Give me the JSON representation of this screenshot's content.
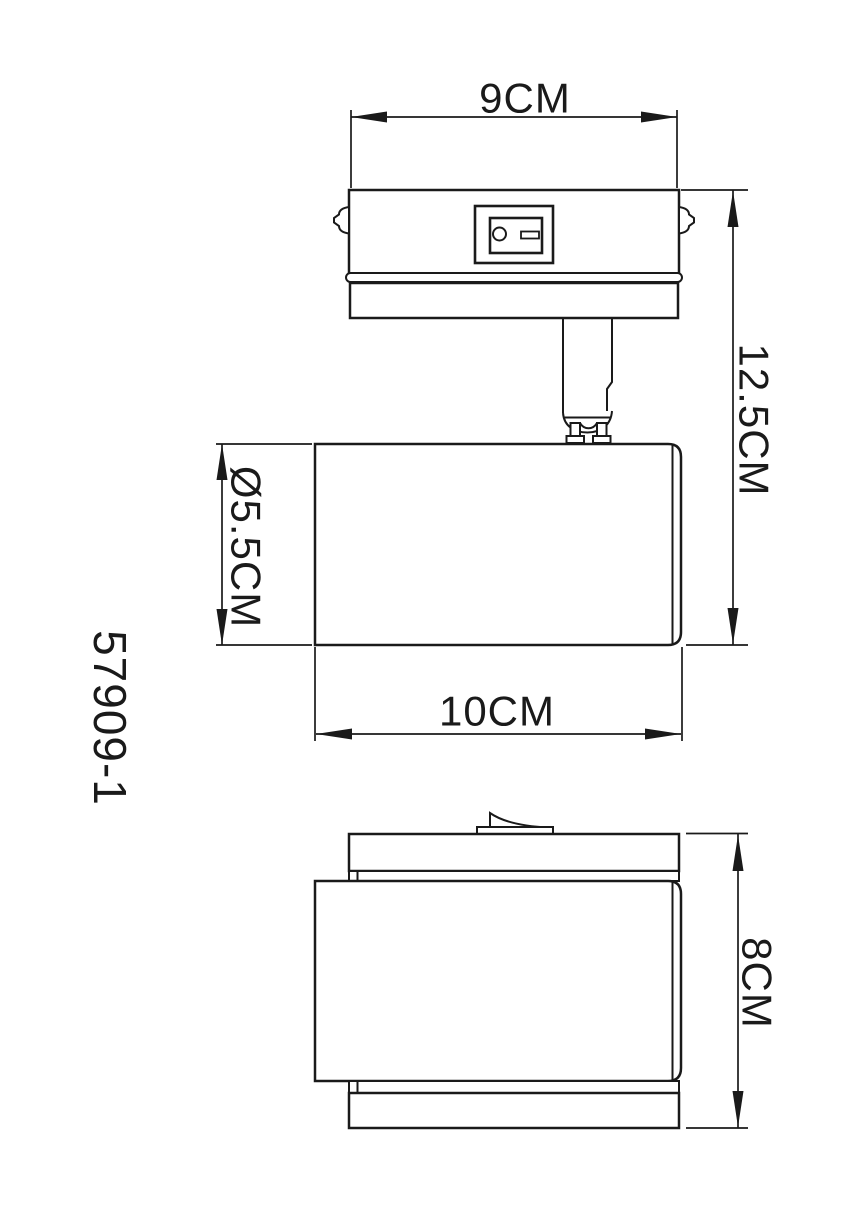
{
  "page": {
    "background": "#ffffff",
    "line_color": "#1a1a1a"
  },
  "labels": {
    "model_number": "57909-1",
    "bracket_width": "9CM",
    "overall_height": "12.5CM",
    "head_diameter": "Ø5.5CM",
    "head_length": "10CM",
    "body_height": "8CM"
  }
}
